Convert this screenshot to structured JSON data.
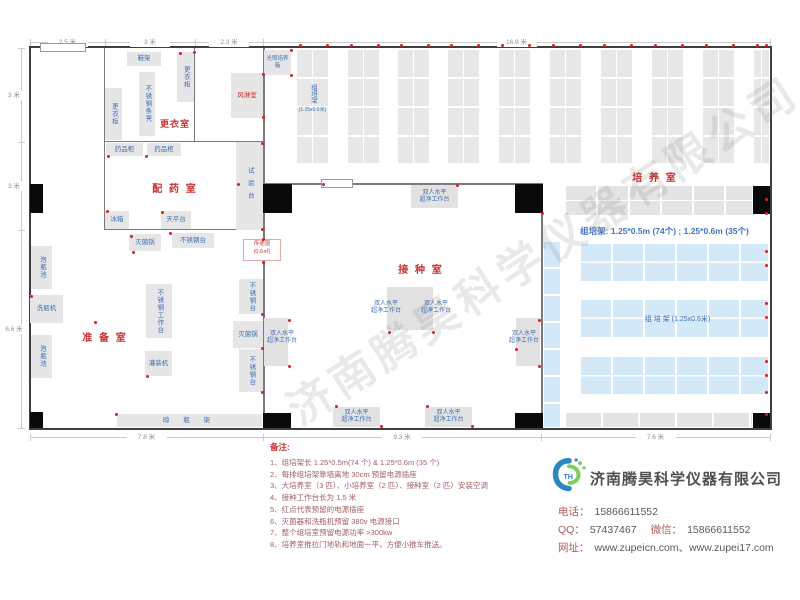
{
  "watermark": "济南腾昊科学仪器有限公司",
  "colors": {
    "room_label": "#c53030",
    "equipment_text": "#3f6eb4",
    "rack_blue": "#d3e9f8",
    "outlet_red": "#d42222"
  },
  "plan": {
    "spec_text": "组培架: 1.25*0.5m (74个) ; 1.25*0.6m (35个)",
    "room_labels": [
      {
        "t": "更衣室",
        "x": 175,
        "y": 123,
        "fs": 9,
        "ls": 1
      },
      {
        "t": "配 药 室",
        "x": 175,
        "y": 186,
        "fs": 10,
        "ls": 2
      },
      {
        "t": "准 备 室",
        "x": 105,
        "y": 335,
        "fs": 10,
        "ls": 2
      },
      {
        "t": "接 种 室",
        "x": 421,
        "y": 267,
        "fs": 10,
        "ls": 2
      },
      {
        "t": "培 养 室",
        "x": 655,
        "y": 175,
        "fs": 10,
        "ls": 2
      }
    ],
    "equipment": [
      {
        "t": "鞋架",
        "x": 127,
        "y": 52,
        "w": 34,
        "h": 14
      },
      {
        "t": "更衣柜",
        "x": 177,
        "y": 52,
        "w": 17,
        "h": 50,
        "v": 1
      },
      {
        "t": "不锈钢条凳",
        "x": 139,
        "y": 72,
        "w": 16,
        "h": 64,
        "v": 1
      },
      {
        "t": "更衣柜",
        "x": 105,
        "y": 88,
        "w": 17,
        "h": 52,
        "v": 1
      },
      {
        "t": "风淋室",
        "x": 231,
        "y": 73,
        "w": 32,
        "h": 45,
        "red": 1
      },
      {
        "t": "光照培养箱",
        "x": 264,
        "y": 50,
        "w": 27,
        "h": 25,
        "fs": 5.5
      },
      {
        "t": "药品柜",
        "x": 106,
        "y": 143,
        "w": 37,
        "h": 13
      },
      {
        "t": "药品柜",
        "x": 147,
        "y": 143,
        "w": 34,
        "h": 13
      },
      {
        "t": "试验台",
        "x": 236,
        "y": 142,
        "w": 27,
        "h": 88,
        "v": 1,
        "ls": 6
      },
      {
        "t": "冰箱",
        "x": 105,
        "y": 211,
        "w": 24,
        "h": 18
      },
      {
        "t": "天平台",
        "x": 161,
        "y": 211,
        "w": 30,
        "h": 18
      },
      {
        "t": "灭菌锅",
        "x": 129,
        "y": 234,
        "w": 32,
        "h": 17
      },
      {
        "t": "不锈钢台",
        "x": 172,
        "y": 233,
        "w": 42,
        "h": 15
      },
      {
        "t": "泡瓶池",
        "x": 31,
        "y": 246,
        "w": 21,
        "h": 43,
        "v": 1
      },
      {
        "t": "洗瓶机",
        "x": 30,
        "y": 295,
        "w": 33,
        "h": 28
      },
      {
        "t": "泡瓶池",
        "x": 31,
        "y": 335,
        "w": 21,
        "h": 43,
        "v": 1
      },
      {
        "t": "不锈钢工作台",
        "x": 146,
        "y": 284,
        "w": 26,
        "h": 54,
        "v": 1
      },
      {
        "t": "灌装机",
        "x": 145,
        "y": 351,
        "w": 27,
        "h": 25
      },
      {
        "t": "不锈钢台",
        "x": 239,
        "y": 279,
        "w": 24,
        "h": 35,
        "v": 1
      },
      {
        "t": "灭菌锅",
        "x": 233,
        "y": 321,
        "w": 30,
        "h": 27
      },
      {
        "t": "不锈钢台",
        "x": 239,
        "y": 349,
        "w": 24,
        "h": 43,
        "v": 1
      },
      {
        "t": "晾 瓶 架",
        "x": 117,
        "y": 414,
        "w": 145,
        "h": 13,
        "ls": 6
      }
    ],
    "benches": {
      "label_line1": "双人水平",
      "label_line2": "超净工作台",
      "boxes": [
        {
          "x": 411,
          "y": 185,
          "w": 47,
          "h": 23,
          "inside": 1
        },
        {
          "x": 387,
          "y": 287,
          "w": 23,
          "h": 43,
          "lblAt": [
            362,
            301
          ]
        },
        {
          "x": 410,
          "y": 287,
          "w": 23,
          "h": 43,
          "lblAt": [
            412,
            301
          ]
        },
        {
          "x": 264,
          "y": 318,
          "w": 24,
          "h": 48,
          "lblAt": [
            258,
            331
          ]
        },
        {
          "x": 516,
          "y": 318,
          "w": 24,
          "h": 48,
          "lblAt": [
            500,
            331
          ]
        },
        {
          "x": 333,
          "y": 407,
          "w": 47,
          "h": 20,
          "inside": 1
        },
        {
          "x": 425,
          "y": 407,
          "w": 47,
          "h": 20,
          "inside": 1
        }
      ]
    },
    "racks": {
      "vertical_xs": [
        297,
        348,
        398,
        448,
        499,
        550,
        601,
        652,
        703,
        754
      ],
      "vertical_y": 50,
      "vertical_w": 31,
      "vertical_h": 113,
      "last_w": 15,
      "first_label_top": "组培架",
      "first_label_bottom": "(1.25x0.5米)",
      "gray_top": [
        566,
        186,
        186,
        29
      ],
      "gray_bottom": [
        566,
        413,
        186,
        14
      ],
      "blue_vertical": [
        544,
        242,
        16,
        185
      ],
      "blue_rows_x": 581,
      "blue_rows_w": 187,
      "blue_rows_h": 37,
      "blue_rows_ys": [
        244,
        300,
        357
      ],
      "blue_label": "组 培 架 (1.25x0.6米)"
    },
    "pass_window": {
      "line1": "传递窗",
      "line2": "(0.6㎡)",
      "x": 243,
      "y": 239,
      "w": 38,
      "h": 22
    },
    "walls": [
      [
        104,
        48,
        1,
        182
      ],
      [
        194,
        48,
        1,
        94
      ],
      [
        104,
        141,
        160,
        1
      ],
      [
        104,
        229,
        160,
        1
      ],
      [
        263,
        48,
        1.5,
        380
      ],
      [
        263,
        183,
        280,
        1.5
      ],
      [
        541,
        184,
        1.5,
        244
      ]
    ],
    "columns": [
      [
        30,
        184,
        13,
        29
      ],
      [
        30,
        412,
        13,
        16
      ],
      [
        263,
        184,
        29,
        29
      ],
      [
        515,
        184,
        28,
        29
      ],
      [
        753,
        186,
        17,
        28
      ],
      [
        263,
        413,
        28,
        15
      ],
      [
        515,
        413,
        28,
        15
      ],
      [
        753,
        413,
        17,
        15
      ]
    ],
    "doors": [
      [
        40,
        43,
        46,
        9
      ],
      [
        321,
        179,
        32,
        9
      ]
    ],
    "outlets": [
      [
        300,
        45
      ],
      [
        327,
        45
      ],
      [
        351,
        45
      ],
      [
        378,
        45
      ],
      [
        401,
        45
      ],
      [
        428,
        45
      ],
      [
        451,
        45
      ],
      [
        478,
        45
      ],
      [
        502,
        45
      ],
      [
        529,
        45
      ],
      [
        553,
        45
      ],
      [
        580,
        45
      ],
      [
        604,
        45
      ],
      [
        631,
        45
      ],
      [
        655,
        45
      ],
      [
        682,
        45
      ],
      [
        706,
        45
      ],
      [
        733,
        45
      ],
      [
        757,
        45
      ],
      [
        766,
        45
      ],
      [
        766,
        199
      ],
      [
        766,
        213
      ],
      [
        766,
        251
      ],
      [
        766,
        265
      ],
      [
        766,
        303
      ],
      [
        766,
        317
      ],
      [
        766,
        361
      ],
      [
        766,
        375
      ],
      [
        766,
        392
      ],
      [
        766,
        414
      ],
      [
        323,
        184
      ],
      [
        457,
        185
      ],
      [
        389,
        332
      ],
      [
        433,
        332
      ],
      [
        289,
        320
      ],
      [
        289,
        366
      ],
      [
        539,
        320
      ],
      [
        539,
        366
      ],
      [
        336,
        406
      ],
      [
        381,
        426
      ],
      [
        427,
        406
      ],
      [
        472,
        426
      ],
      [
        542,
        213
      ],
      [
        516,
        349
      ],
      [
        31,
        296
      ],
      [
        95,
        322
      ],
      [
        133,
        252
      ],
      [
        147,
        376
      ],
      [
        262,
        314
      ],
      [
        262,
        348
      ],
      [
        262,
        392
      ],
      [
        116,
        414
      ],
      [
        263,
        239
      ],
      [
        263,
        262
      ],
      [
        170,
        233
      ],
      [
        108,
        156
      ],
      [
        146,
        156
      ],
      [
        262,
        143
      ],
      [
        262,
        229
      ],
      [
        107,
        211
      ],
      [
        162,
        212
      ],
      [
        238,
        184
      ],
      [
        131,
        236
      ],
      [
        194,
        52
      ],
      [
        263,
        74
      ],
      [
        263,
        117
      ],
      [
        291,
        50
      ],
      [
        291,
        75
      ],
      [
        180,
        53
      ]
    ],
    "dimensions": {
      "top": {
        "y": 42,
        "segments": [
          {
            "from": 30,
            "to": 105,
            "label": "2.5 米"
          },
          {
            "from": 105,
            "to": 195,
            "label": "3 米"
          },
          {
            "from": 195,
            "to": 263,
            "label": "2.3 米"
          },
          {
            "from": 263,
            "to": 770,
            "label": "16.9 米"
          }
        ]
      },
      "left": {
        "x": 21,
        "segments": [
          {
            "from": 48,
            "to": 142,
            "label": "3 米"
          },
          {
            "from": 142,
            "to": 230,
            "label": "3 米"
          },
          {
            "from": 230,
            "to": 428,
            "label": "6.6 米"
          }
        ]
      },
      "bottom": {
        "y": 437,
        "segments": [
          {
            "from": 30,
            "to": 263,
            "label": "7.8 米"
          },
          {
            "from": 263,
            "to": 541,
            "label": "9.3 米"
          },
          {
            "from": 541,
            "to": 770,
            "label": "7.6 米"
          }
        ]
      }
    }
  },
  "notes": {
    "title": "备注:",
    "items": [
      "1、组培架长 1.25*0.5m(74 个) & 1.25*0.6m (35 个)",
      "2、每排组培架靠墙离地 30cm 预留电源插座",
      "3、大培养室（3 匹）、小培养室（2 匹）、接种室（2 匹）安装空调",
      "4、接种工作台长为 1.5 米",
      "5、红点代表预留的电源插座",
      "6、灭菌器和洗瓶机预留 380v 电源接口",
      "7、整个组培室预留电源功率 >300kw",
      "8、培养室推拉门地轨和地面一平，方便小推车推送。"
    ]
  },
  "company": {
    "name": "济南腾昊科学仪器有限公司",
    "phone_label": "电话：",
    "phone": "15866611552",
    "qq_label": "QQ：",
    "qq": "57437467",
    "wechat_label": "微信：",
    "wechat": "15866611552",
    "web_label": "网址：",
    "websites": "www.zupeicn.com、www.zupei17.com"
  }
}
